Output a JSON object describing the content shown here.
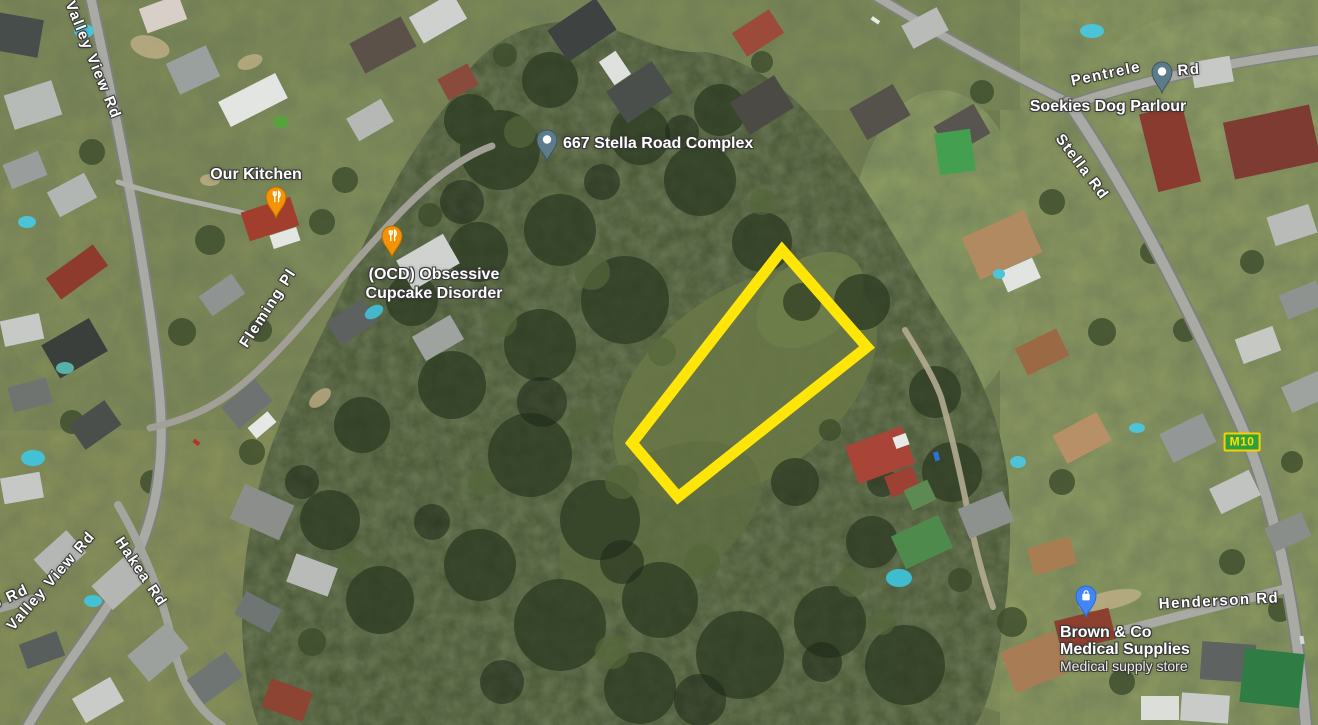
{
  "map": {
    "view_type": "satellite",
    "road_labels": {
      "valley_view_top": "Valley View Rd",
      "fleming_pl": "Fleming Pl",
      "pentrele_part": "Pentrele",
      "pentrele_rd_part": "Rd",
      "stella": "Stella Rd",
      "hakea": "Hakea Rd",
      "valley_view_bottom": "Valley View Rd",
      "partial_left": "o Rd",
      "henderson": "Henderson Rd"
    },
    "route_badge": {
      "text": "M10",
      "bg_color": "#2f9e41",
      "border_color": "#f7d000",
      "text_color": "#ffe000"
    },
    "pois": {
      "our_kitchen": {
        "name": "Our Kitchen",
        "category": "restaurant"
      },
      "ocd": {
        "line1": "(OCD) Obsessive",
        "line2": "Cupcake Disorder",
        "category": "restaurant"
      },
      "stella_complex": {
        "name": "667 Stella Road Complex",
        "category": "place"
      },
      "soekies": {
        "name": "Soekies Dog Parlour",
        "category": "place"
      },
      "brown": {
        "line1": "Brown & Co",
        "line2": "Medical Supplies",
        "subtitle": "Medical supply store",
        "category": "store"
      }
    },
    "pin_colors": {
      "restaurant": "#f49208",
      "default": "#5d7c8b",
      "store": "#4285f4"
    },
    "highlight_plot": {
      "stroke": "#ffe608",
      "stroke_width": "11",
      "points": "782,250 867,347 678,497 632,443"
    }
  }
}
